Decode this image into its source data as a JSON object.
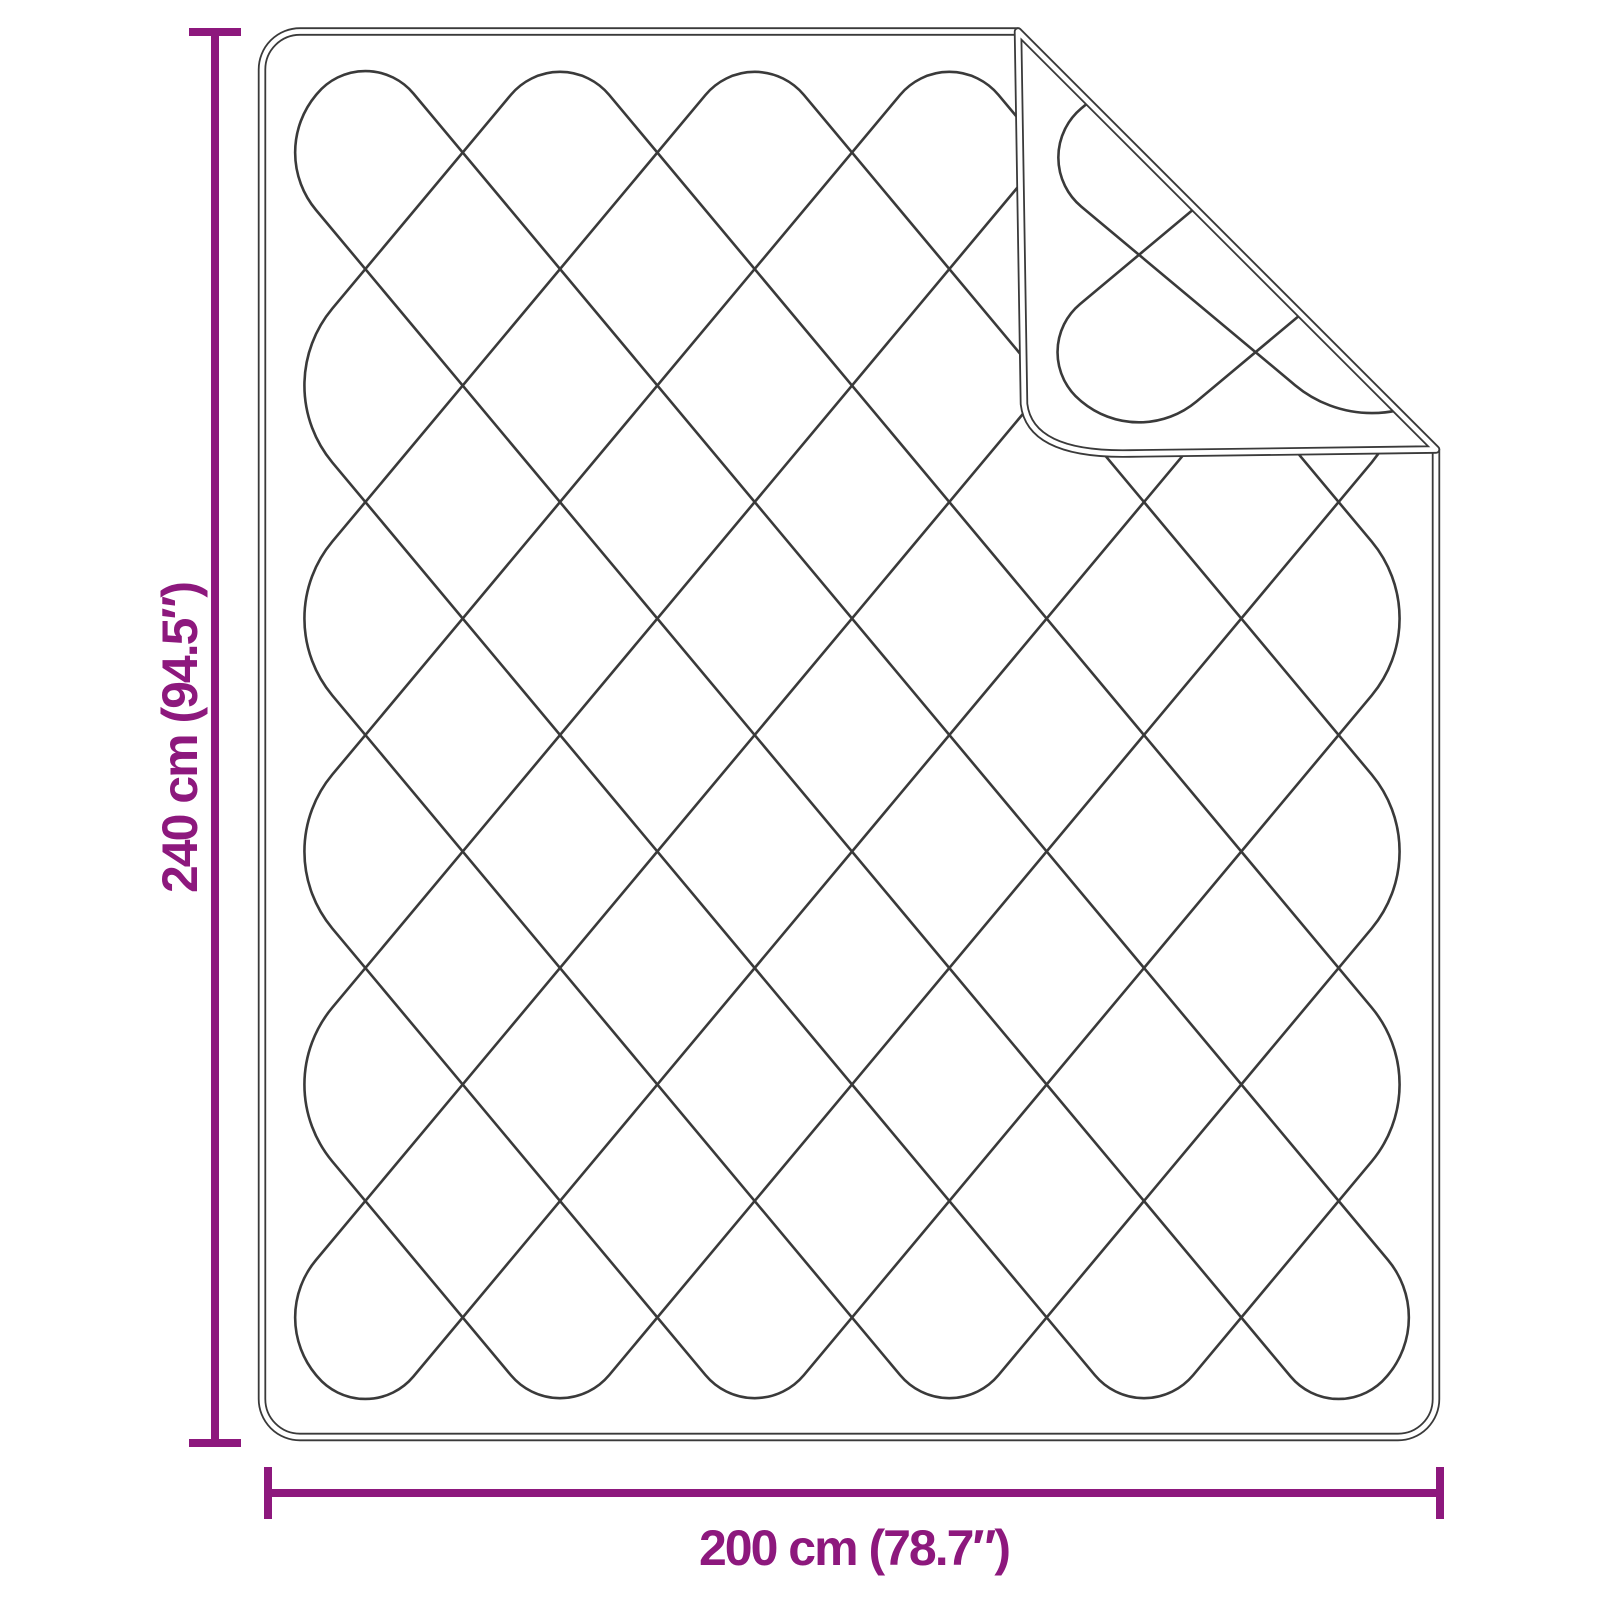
{
  "diagram": {
    "height_label": "240 cm (94.5″)",
    "width_label": "200 cm (78.7″)",
    "colors": {
      "dimension": "#8D187D",
      "line_art": "#3A3A3A",
      "background": "#FFFFFF"
    }
  }
}
